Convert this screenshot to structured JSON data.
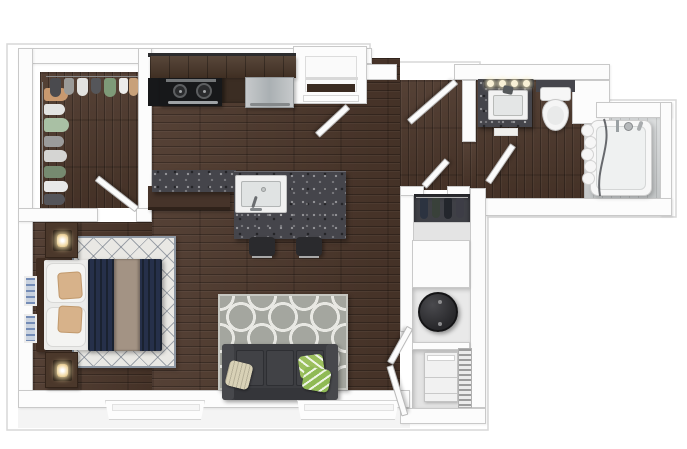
{
  "scene": {
    "type": "3d-floorplan-top-view",
    "description": "3D top-down rendering of a one-bedroom apartment floor plan, no text labels",
    "background": "#ffffff"
  },
  "palette": {
    "wood": "#4c372b",
    "wall": "#fcfcfc",
    "wall_edge": "#c9c9c9",
    "outline": "#d7d7d7",
    "granite": "#45454b",
    "counter_black": "#17181a",
    "cabinet": "#4a3729",
    "stainless": "#bcbfc1",
    "fixture_white": "#f4f4f4",
    "tile": "#d0d3d4",
    "sofa": "#3c3d41",
    "duvet": "#212a3c",
    "runner": "#a39384",
    "accent_pillow": "#d7b28a",
    "cream_pillow": "#d8d1b6",
    "green_pillow": "#9cc05e",
    "rug_bedroom": "#e9e8e4",
    "rug_living": "#a4a69f",
    "rug_pattern": "#e8e8e3",
    "lamp_glow": "#f2ddad",
    "heater": "#28282b",
    "coat_back": "#3f4046"
  },
  "rooms": [
    {
      "name": "bedroom-closet",
      "items": [
        "hanging-clothes-left-rod",
        "hanging-clothes-top-rod",
        "swing-door"
      ]
    },
    {
      "name": "kitchen",
      "items": [
        "upper-cabinet-run",
        "black-counter",
        "range-two-burners",
        "stainless-refrigerator",
        "island-peninsula",
        "island-sink-with-faucet",
        "bar-stool",
        "bar-stool"
      ]
    },
    {
      "name": "entry",
      "items": [
        "entry-door",
        "entry-nook-with-shelf",
        "nook-door"
      ]
    },
    {
      "name": "living-room",
      "items": [
        "quatrefoil-rug",
        "sofa-three-seats",
        "cream-pillow",
        "green-pillow",
        "green-pillow",
        "window"
      ]
    },
    {
      "name": "bedroom",
      "items": [
        "bed-navy-duvet",
        "taupe-runner",
        "white-pillows",
        "accent-pillows",
        "headboard",
        "nightstand-with-lamp",
        "nightstand-with-lamp",
        "diamond-lattice-rug",
        "wall-art",
        "wall-art",
        "window"
      ]
    },
    {
      "name": "hallway",
      "items": [
        "coat-closet-with-door",
        "bathroom-door"
      ]
    },
    {
      "name": "utility-closets",
      "items": [
        "water-heater-round",
        "washer-dryer",
        "vent-grille",
        "double-louver-doors"
      ]
    },
    {
      "name": "bathroom",
      "items": [
        "granite-vanity",
        "vanity-sink",
        "vanity-light-bar",
        "toilet",
        "bath-mat",
        "tub-shower-tile-surround",
        "bathtub",
        "shower-curtain",
        "curved-glass-screen",
        "shower-fixtures"
      ]
    }
  ],
  "counts": {
    "vanity_bulbs": 4,
    "bar_stools": 2,
    "windows": 2,
    "doors": 7,
    "hanging_coats": 4
  }
}
